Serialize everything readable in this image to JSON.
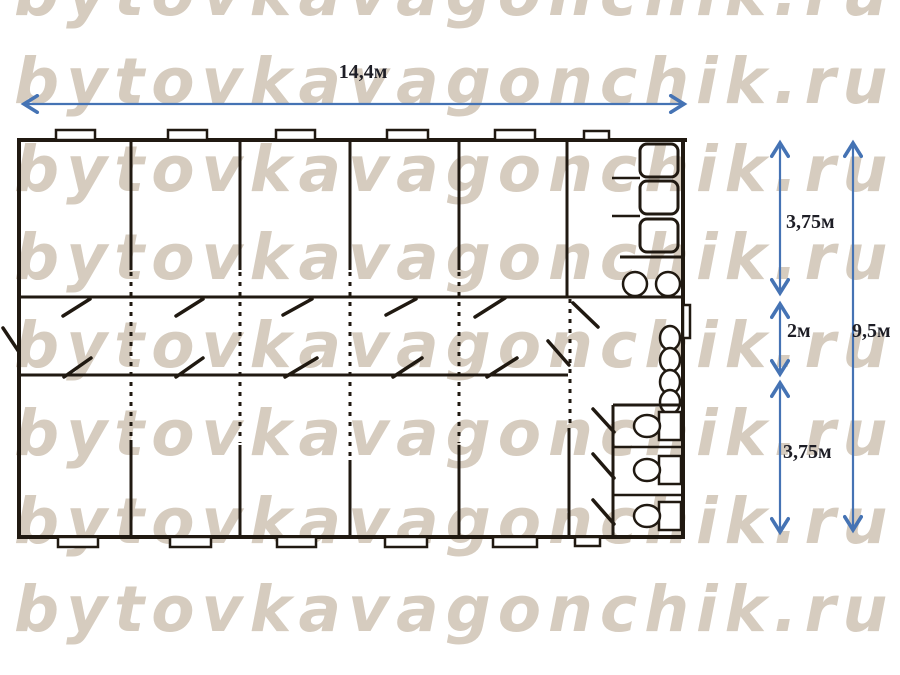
{
  "watermark": {
    "text": "bytovkavagonchik.ru"
  },
  "dimensions": {
    "width": "14,4м",
    "top_section": "3,75м",
    "corridor": "2м",
    "bottom_section": "3,75м",
    "total_depth": "9,5м"
  },
  "colors": {
    "arrow_blue": "#4573b4",
    "line_dark": "#201911",
    "watermark_beige": "#d6ccbf",
    "label_dark": "#1e1e26"
  }
}
